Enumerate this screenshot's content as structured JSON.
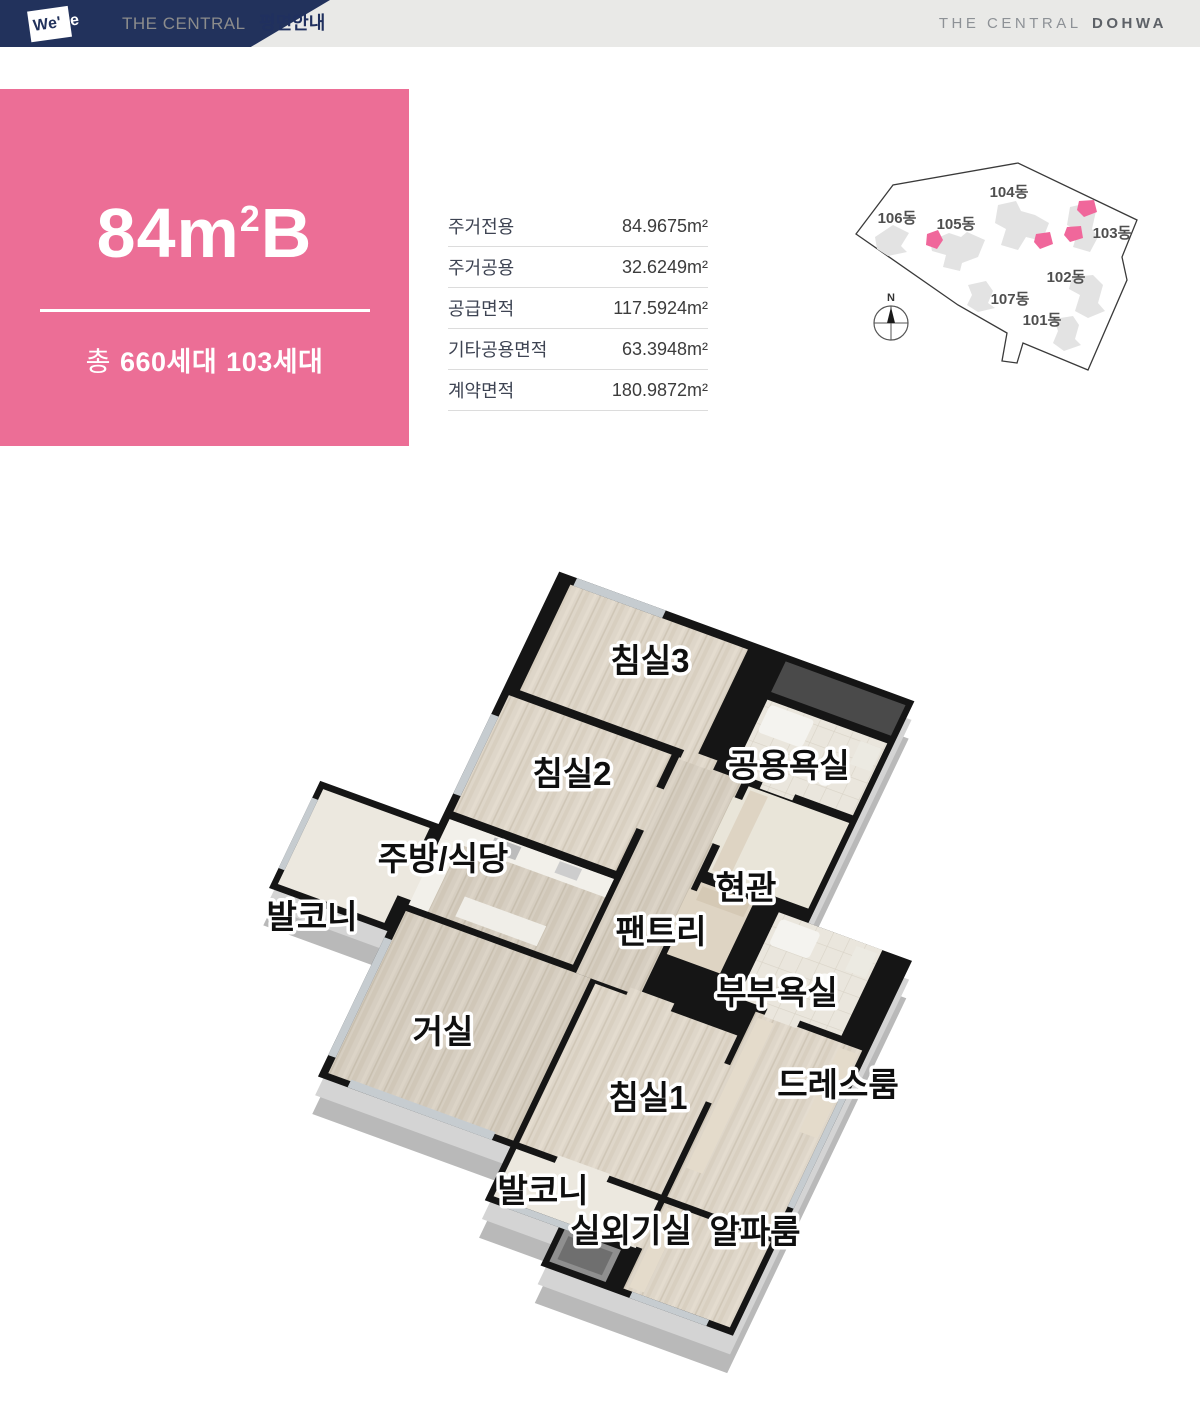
{
  "header": {
    "logo_we": "We'",
    "logo_ve": "ve",
    "left_title": "THE CENTRAL",
    "left_subtitle": "평면안내",
    "right_title": "THE CENTRAL",
    "right_title_bold": "DOHWA"
  },
  "unit": {
    "size": "84m",
    "size_sup": "2",
    "type": "B",
    "total_prefix": "총",
    "total_value": "660세대",
    "type_value": "103세대"
  },
  "area_table": {
    "rows": [
      {
        "label": "주거전용",
        "value": "84.9675m²"
      },
      {
        "label": "주거공용",
        "value": "32.6249m²"
      },
      {
        "label": "공급면적",
        "value": "117.5924m²"
      },
      {
        "label": "기타공용면적",
        "value": "63.3948m²"
      },
      {
        "label": "계약면적",
        "value": "180.9872m²"
      }
    ]
  },
  "site_plan": {
    "compass_label": "N",
    "highlight_color": "#f0679b",
    "buildings": [
      {
        "name": "101동"
      },
      {
        "name": "102동"
      },
      {
        "name": "103동",
        "highlighted": true
      },
      {
        "name": "104동"
      },
      {
        "name": "105동"
      },
      {
        "name": "106동"
      },
      {
        "name": "107동"
      }
    ]
  },
  "floor_plan": {
    "rooms": [
      {
        "label": "침실3"
      },
      {
        "label": "침실2"
      },
      {
        "label": "공용욕실"
      },
      {
        "label": "주방/식당"
      },
      {
        "label": "발코니"
      },
      {
        "label": "현관"
      },
      {
        "label": "팬트리"
      },
      {
        "label": "부부욕실"
      },
      {
        "label": "거실"
      },
      {
        "label": "침실1"
      },
      {
        "label": "드레스룸"
      },
      {
        "label": "발코니"
      },
      {
        "label": "실외기실"
      },
      {
        "label": "알파룸"
      }
    ]
  },
  "colors": {
    "accent_pink": "#ec6e96",
    "navy": "#22325c"
  }
}
